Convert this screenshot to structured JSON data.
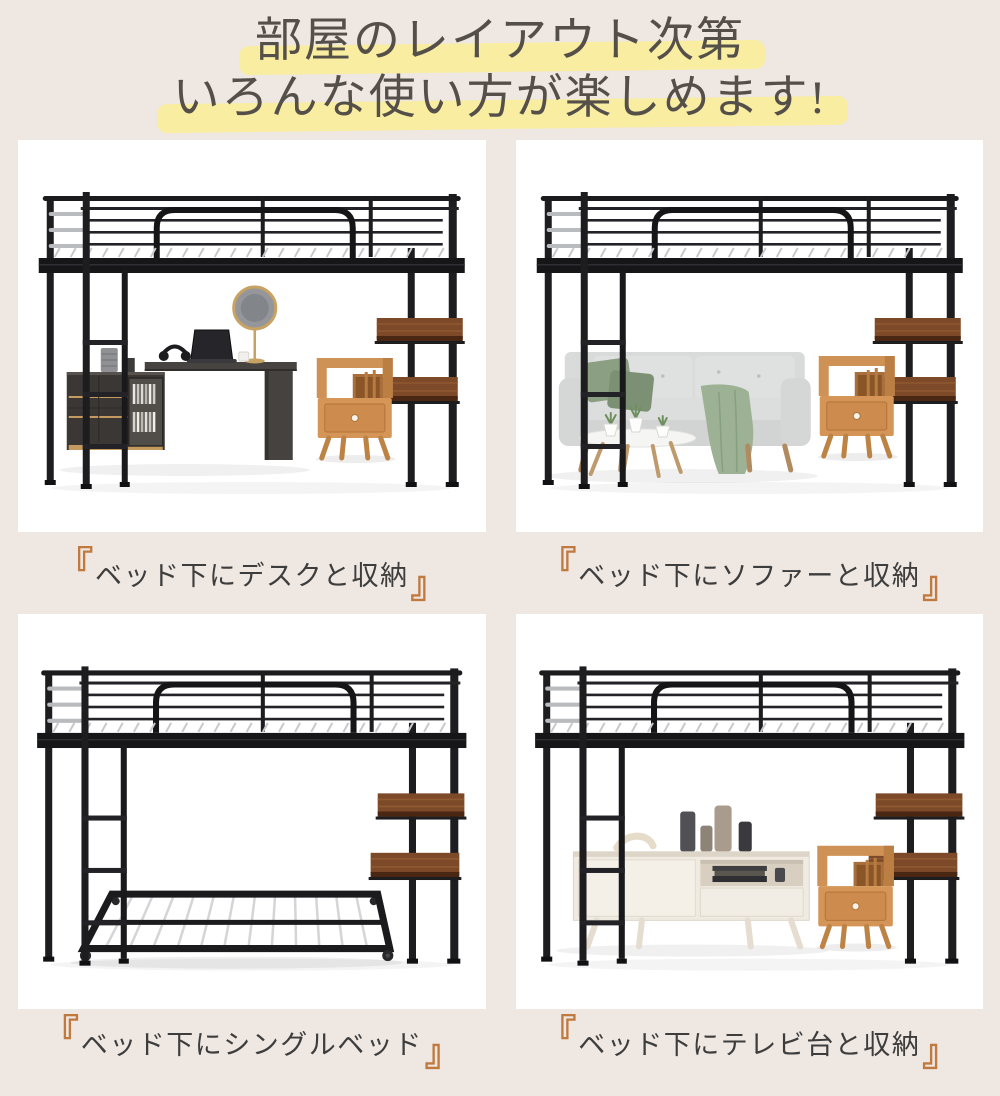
{
  "title": {
    "line1": "部屋のレイアウト次第",
    "line2": "いろんな使い方が楽しめます!"
  },
  "captions": {
    "bracket_open": "『",
    "bracket_close": "』"
  },
  "panels": [
    {
      "caption": "ベッド下にデスクと収納",
      "scene": "loft-bed-with-desk-and-storage"
    },
    {
      "caption": "ベッド下にソファーと収納",
      "scene": "loft-bed-with-sofa-and-storage"
    },
    {
      "caption": "ベッド下にシングルベッド",
      "scene": "loft-bed-with-single-bed"
    },
    {
      "caption": "ベッド下にテレビ台と収納",
      "scene": "loft-bed-with-tv-stand-and-storage"
    }
  ],
  "colors": {
    "page_background": "#efe7e1",
    "panel_background": "#ffffff",
    "title_text": "#544f49",
    "title_highlight": "#f8eda1",
    "caption_text": "#3d3d3d",
    "caption_bracket": "#c0793f",
    "bed_frame_black": "#1d1d20",
    "ladder_silver": "#b9bcbf",
    "shelf_wood_brown": "#7c4a28",
    "nightstand_wood": "#cf9256",
    "sofa_gray": "#d7d9d8",
    "cushion_green": "#8ba083",
    "throw_green": "#9db295",
    "desk_dark": "#3b3734",
    "tv_stand_cream": "#f0ebe2"
  }
}
